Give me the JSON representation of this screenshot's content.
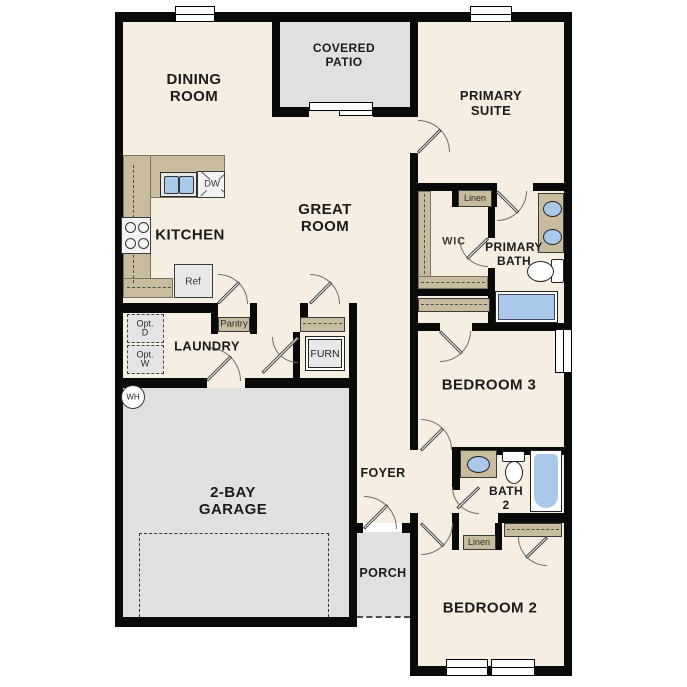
{
  "title": "Single-story floor plan",
  "colors": {
    "wall": "#0a0a0a",
    "floor": "#f6eee1",
    "outdoor": "#e0e0e0",
    "counter": "#c9bb9e",
    "fixture": "#a9c8ea",
    "appliance": "#e8e8e8"
  },
  "rooms": {
    "dining": "DINING\nROOM",
    "covered_patio": "COVERED\nPATIO",
    "primary_suite": "PRIMARY\nSUITE",
    "kitchen": "KITCHEN",
    "great_room": "GREAT\nROOM",
    "wic": "WIC",
    "primary_bath": "PRIMARY\nBATH",
    "laundry": "LAUNDRY",
    "bedroom3": "BEDROOM 3",
    "bath2": "BATH\n2",
    "garage": "2-BAY\nGARAGE",
    "foyer": "FOYER",
    "porch": "PORCH",
    "bedroom2": "BEDROOM 2"
  },
  "fixtures": {
    "pantry": "Pantry",
    "linen_primary": "Linen",
    "linen_hall": "Linen",
    "furnace": "FURN",
    "refrigerator": "Ref",
    "dishwasher": "DW",
    "water_heater": "WH",
    "optional_dryer": "Opt.\nD",
    "optional_washer": "Opt.\nW"
  }
}
